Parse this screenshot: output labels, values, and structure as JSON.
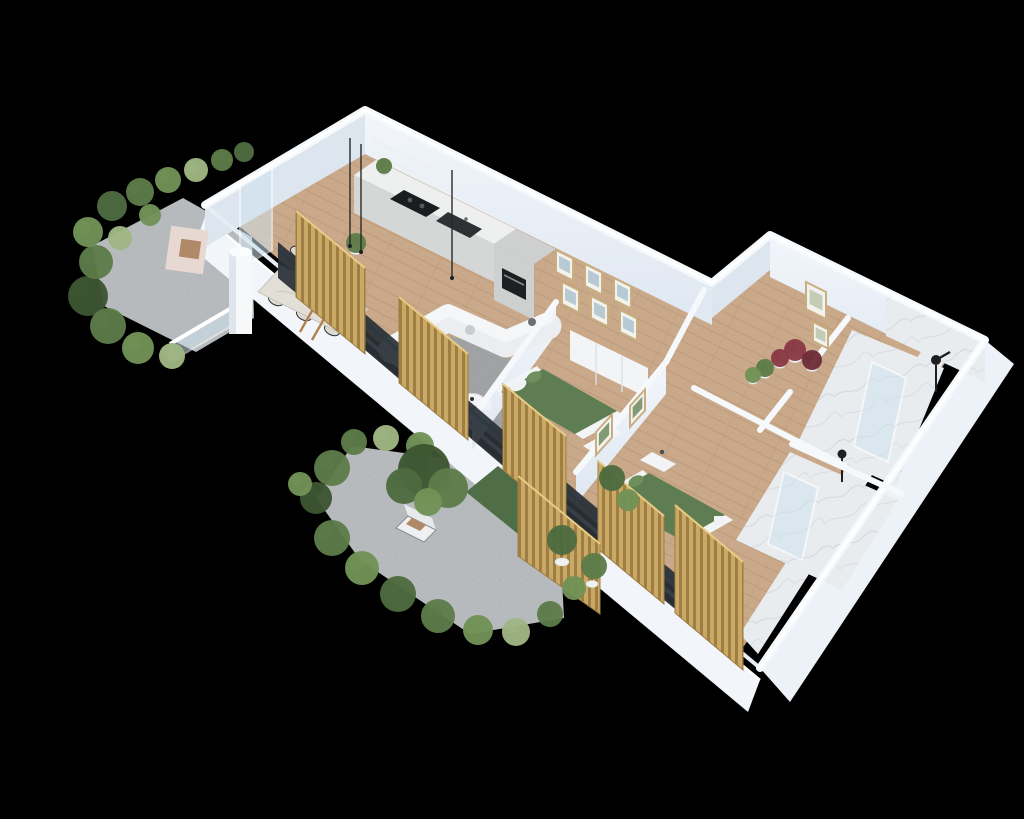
{
  "meta": {
    "title": "Isometric 3D apartment floor plan render",
    "canvas": {
      "width": 1024,
      "height": 819
    }
  },
  "colors": {
    "bg": "#000000",
    "wallTop": "#f6f9fc",
    "wallFaceDark": "#dde5ef",
    "wood": "#c9a98a",
    "woodLine": "#b3927300",
    "woodLineSolid": "#b39273",
    "concrete": "#b7babc",
    "concreteDot": "#a7aaac",
    "rug": "#9aa1a7",
    "marble": "#e9ecef",
    "marbleVein": "#c6cdd5",
    "gold": "#caa964",
    "goldDark": "#9e7e44",
    "goldLight": "#e8cc85",
    "glassBlue": "#2f9fd0",
    "glassPane": "#cfe3ee",
    "frameDark": "#2a3037",
    "bedGreen": "#5f7d52",
    "bedGreenLight": "#6f8f5e",
    "white": "#f2f4f6",
    "sofa": "#ecedf0",
    "black": "#1d1f22",
    "plantG1": "#4e6b3f",
    "plantG2": "#5d7c49",
    "plantG3": "#719256",
    "plantPale": "#9fb683",
    "plantDark": "#3c5531",
    "plantRed": "#8a3a46",
    "plantRedDark": "#6e2d38",
    "pot": "#eef0f2",
    "tan": "#b08968",
    "chairPink": "#e7d9d2",
    "steel": "#8a8d90",
    "artBlue": "#a8bfcc",
    "artGreen": "#6d8a5f",
    "woodFrame": "#c9ae80"
  },
  "scene": {
    "rooms": [
      "terrace-left",
      "kitchen",
      "dining-area",
      "living-area",
      "bedroom-1",
      "bedroom-2",
      "hallway",
      "bathroom-shower-1",
      "bathroom-shower-2",
      "terrace-bottom"
    ],
    "plants": [
      {
        "x": 88,
        "y": 296,
        "r": 20,
        "tone": "dark"
      },
      {
        "x": 108,
        "y": 326,
        "r": 18,
        "tone": "g2"
      },
      {
        "x": 138,
        "y": 348,
        "r": 16,
        "tone": "g3"
      },
      {
        "x": 172,
        "y": 356,
        "r": 13,
        "tone": "pale"
      },
      {
        "x": 96,
        "y": 262,
        "r": 17,
        "tone": "g2"
      },
      {
        "x": 88,
        "y": 232,
        "r": 15,
        "tone": "g3"
      },
      {
        "x": 112,
        "y": 206,
        "r": 15,
        "tone": "g1"
      },
      {
        "x": 140,
        "y": 192,
        "r": 14,
        "tone": "g2"
      },
      {
        "x": 168,
        "y": 180,
        "r": 13,
        "tone": "g3"
      },
      {
        "x": 196,
        "y": 170,
        "r": 12,
        "tone": "pale"
      },
      {
        "x": 222,
        "y": 160,
        "r": 11,
        "tone": "g2"
      },
      {
        "x": 244,
        "y": 152,
        "r": 10,
        "tone": "g1"
      },
      {
        "x": 120,
        "y": 238,
        "r": 12,
        "tone": "pale"
      },
      {
        "x": 150,
        "y": 215,
        "r": 11,
        "tone": "g3"
      },
      {
        "x": 332,
        "y": 468,
        "r": 18,
        "tone": "g2"
      },
      {
        "x": 316,
        "y": 498,
        "r": 16,
        "tone": "dark"
      },
      {
        "x": 332,
        "y": 538,
        "r": 18,
        "tone": "g2"
      },
      {
        "x": 362,
        "y": 568,
        "r": 17,
        "tone": "g3"
      },
      {
        "x": 398,
        "y": 594,
        "r": 18,
        "tone": "g1"
      },
      {
        "x": 438,
        "y": 616,
        "r": 17,
        "tone": "g2"
      },
      {
        "x": 478,
        "y": 630,
        "r": 15,
        "tone": "g3"
      },
      {
        "x": 516,
        "y": 632,
        "r": 14,
        "tone": "pale"
      },
      {
        "x": 550,
        "y": 614,
        "r": 13,
        "tone": "g2"
      },
      {
        "x": 574,
        "y": 588,
        "r": 12,
        "tone": "g3"
      },
      {
        "x": 420,
        "y": 446,
        "r": 14,
        "tone": "g3"
      },
      {
        "x": 386,
        "y": 438,
        "r": 13,
        "tone": "pale"
      },
      {
        "x": 354,
        "y": 442,
        "r": 13,
        "tone": "g2"
      },
      {
        "x": 300,
        "y": 484,
        "r": 12,
        "tone": "g3"
      },
      {
        "x": 424,
        "y": 470,
        "r": 26,
        "tone": "dark"
      },
      {
        "x": 404,
        "y": 486,
        "r": 18,
        "tone": "g1"
      },
      {
        "x": 448,
        "y": 488,
        "r": 20,
        "tone": "g2"
      },
      {
        "x": 428,
        "y": 502,
        "r": 14,
        "tone": "g3"
      },
      {
        "x": 562,
        "y": 540,
        "r": 15,
        "tone": "g1"
      },
      {
        "x": 594,
        "y": 566,
        "r": 13,
        "tone": "g2"
      },
      {
        "x": 612,
        "y": 478,
        "r": 13,
        "tone": "g1"
      },
      {
        "x": 628,
        "y": 500,
        "r": 11,
        "tone": "g3"
      },
      {
        "x": 795,
        "y": 350,
        "r": 11,
        "tone": "red",
        "pot": true
      },
      {
        "x": 812,
        "y": 360,
        "r": 10,
        "tone": "redDark",
        "pot": true
      },
      {
        "x": 780,
        "y": 358,
        "r": 9,
        "tone": "red",
        "pot": true
      },
      {
        "x": 765,
        "y": 368,
        "r": 9,
        "tone": "g2",
        "pot": true
      },
      {
        "x": 753,
        "y": 375,
        "r": 8,
        "tone": "g3",
        "pot": true
      },
      {
        "x": 384,
        "y": 166,
        "r": 8,
        "tone": "g2",
        "pot": true
      },
      {
        "x": 356,
        "y": 243,
        "r": 10,
        "tone": "g2",
        "pot": true
      }
    ],
    "slat_panels": [
      {
        "x1": 296,
        "y1": 281,
        "x2": 365,
        "y2": 338,
        "rise": 70,
        "drop": 16
      },
      {
        "x1": 399,
        "y1": 367,
        "x2": 468,
        "y2": 424,
        "rise": 70,
        "drop": 16
      },
      {
        "x1": 503,
        "y1": 454,
        "x2": 566,
        "y2": 506,
        "rise": 70,
        "drop": 16
      },
      {
        "x1": 598,
        "y1": 533,
        "x2": 664,
        "y2": 588,
        "rise": 72,
        "drop": 16
      },
      {
        "x1": 675,
        "y1": 597,
        "x2": 743,
        "y2": 654,
        "rise": 92,
        "drop": 16
      },
      {
        "quad": [
          [
            518,
            476
          ],
          [
            600,
            544
          ],
          [
            600,
            614
          ],
          [
            518,
            556
          ]
        ]
      }
    ],
    "pictures": [
      {
        "x": 556,
        "y": 250,
        "w": 17,
        "h": 22,
        "s": 0.5,
        "type": "art-blue"
      },
      {
        "x": 585,
        "y": 264,
        "w": 17,
        "h": 22,
        "s": 0.5,
        "type": "art-blue"
      },
      {
        "x": 614,
        "y": 278,
        "w": 17,
        "h": 22,
        "s": 0.5,
        "type": "art-blue"
      },
      {
        "x": 562,
        "y": 282,
        "w": 17,
        "h": 22,
        "s": 0.5,
        "type": "art-blue"
      },
      {
        "x": 591,
        "y": 296,
        "w": 17,
        "h": 22,
        "s": 0.5,
        "type": "art-blue"
      },
      {
        "x": 620,
        "y": 310,
        "w": 17,
        "h": 22,
        "s": 0.5,
        "type": "art-blue"
      },
      {
        "x": 806,
        "y": 282,
        "w": 20,
        "h": 27,
        "s": 0.5,
        "type": "botanical"
      },
      {
        "x": 813,
        "y": 322,
        "w": 15,
        "h": 19,
        "s": 0.5,
        "type": "botanical"
      },
      {
        "x": 596,
        "y": 432,
        "w": 16,
        "h": 23,
        "s": -1.1,
        "type": "green"
      },
      {
        "x": 630,
        "y": 406,
        "w": 15,
        "h": 21,
        "s": -1.1,
        "type": "green"
      }
    ]
  }
}
